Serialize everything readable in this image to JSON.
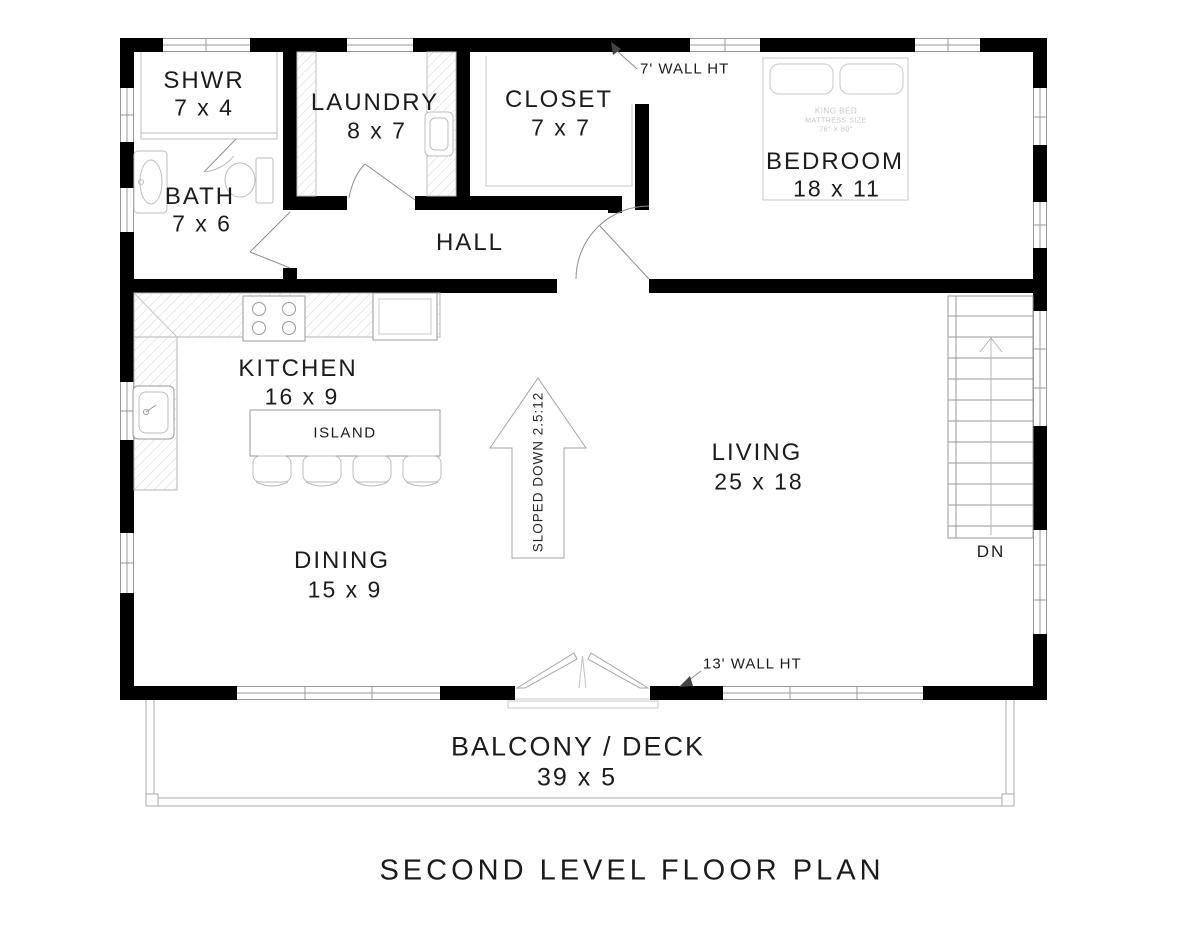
{
  "title": "SECOND LEVEL FLOOR PLAN",
  "rooms": {
    "shwr": {
      "name": "SHWR",
      "dims": "7 x 4"
    },
    "bath": {
      "name": "BATH",
      "dims": "7 x 6"
    },
    "laundry": {
      "name": "LAUNDRY",
      "dims": "8 x 7"
    },
    "closet": {
      "name": "CLOSET",
      "dims": "7 x 7"
    },
    "bedroom": {
      "name": "BEDROOM",
      "dims": "18 x 11"
    },
    "hall": {
      "name": "HALL"
    },
    "kitchen": {
      "name": "KITCHEN",
      "dims": "16 x 9"
    },
    "island": {
      "name": "ISLAND"
    },
    "dining": {
      "name": "DINING",
      "dims": "15 x 9"
    },
    "living": {
      "name": "LIVING",
      "dims": "25 x 18"
    },
    "balcony": {
      "name": "BALCONY / DECK",
      "dims": "39 x 5"
    }
  },
  "annotations": {
    "upper_wall_height": "7' WALL HT",
    "lower_wall_height": "13' WALL HT",
    "slope_arrow": "SLOPED DOWN 2.5:12",
    "stairs_direction": "DN",
    "bed_note": {
      "line1": "KING BED",
      "line2": "MATTRESS SIZE",
      "line3": "76\" X 80\""
    }
  },
  "colors": {
    "wall": "#000000",
    "thin_line": "#9a9a9a",
    "faint_line": "#c8c8c8",
    "text": "#1c1c1c"
  }
}
